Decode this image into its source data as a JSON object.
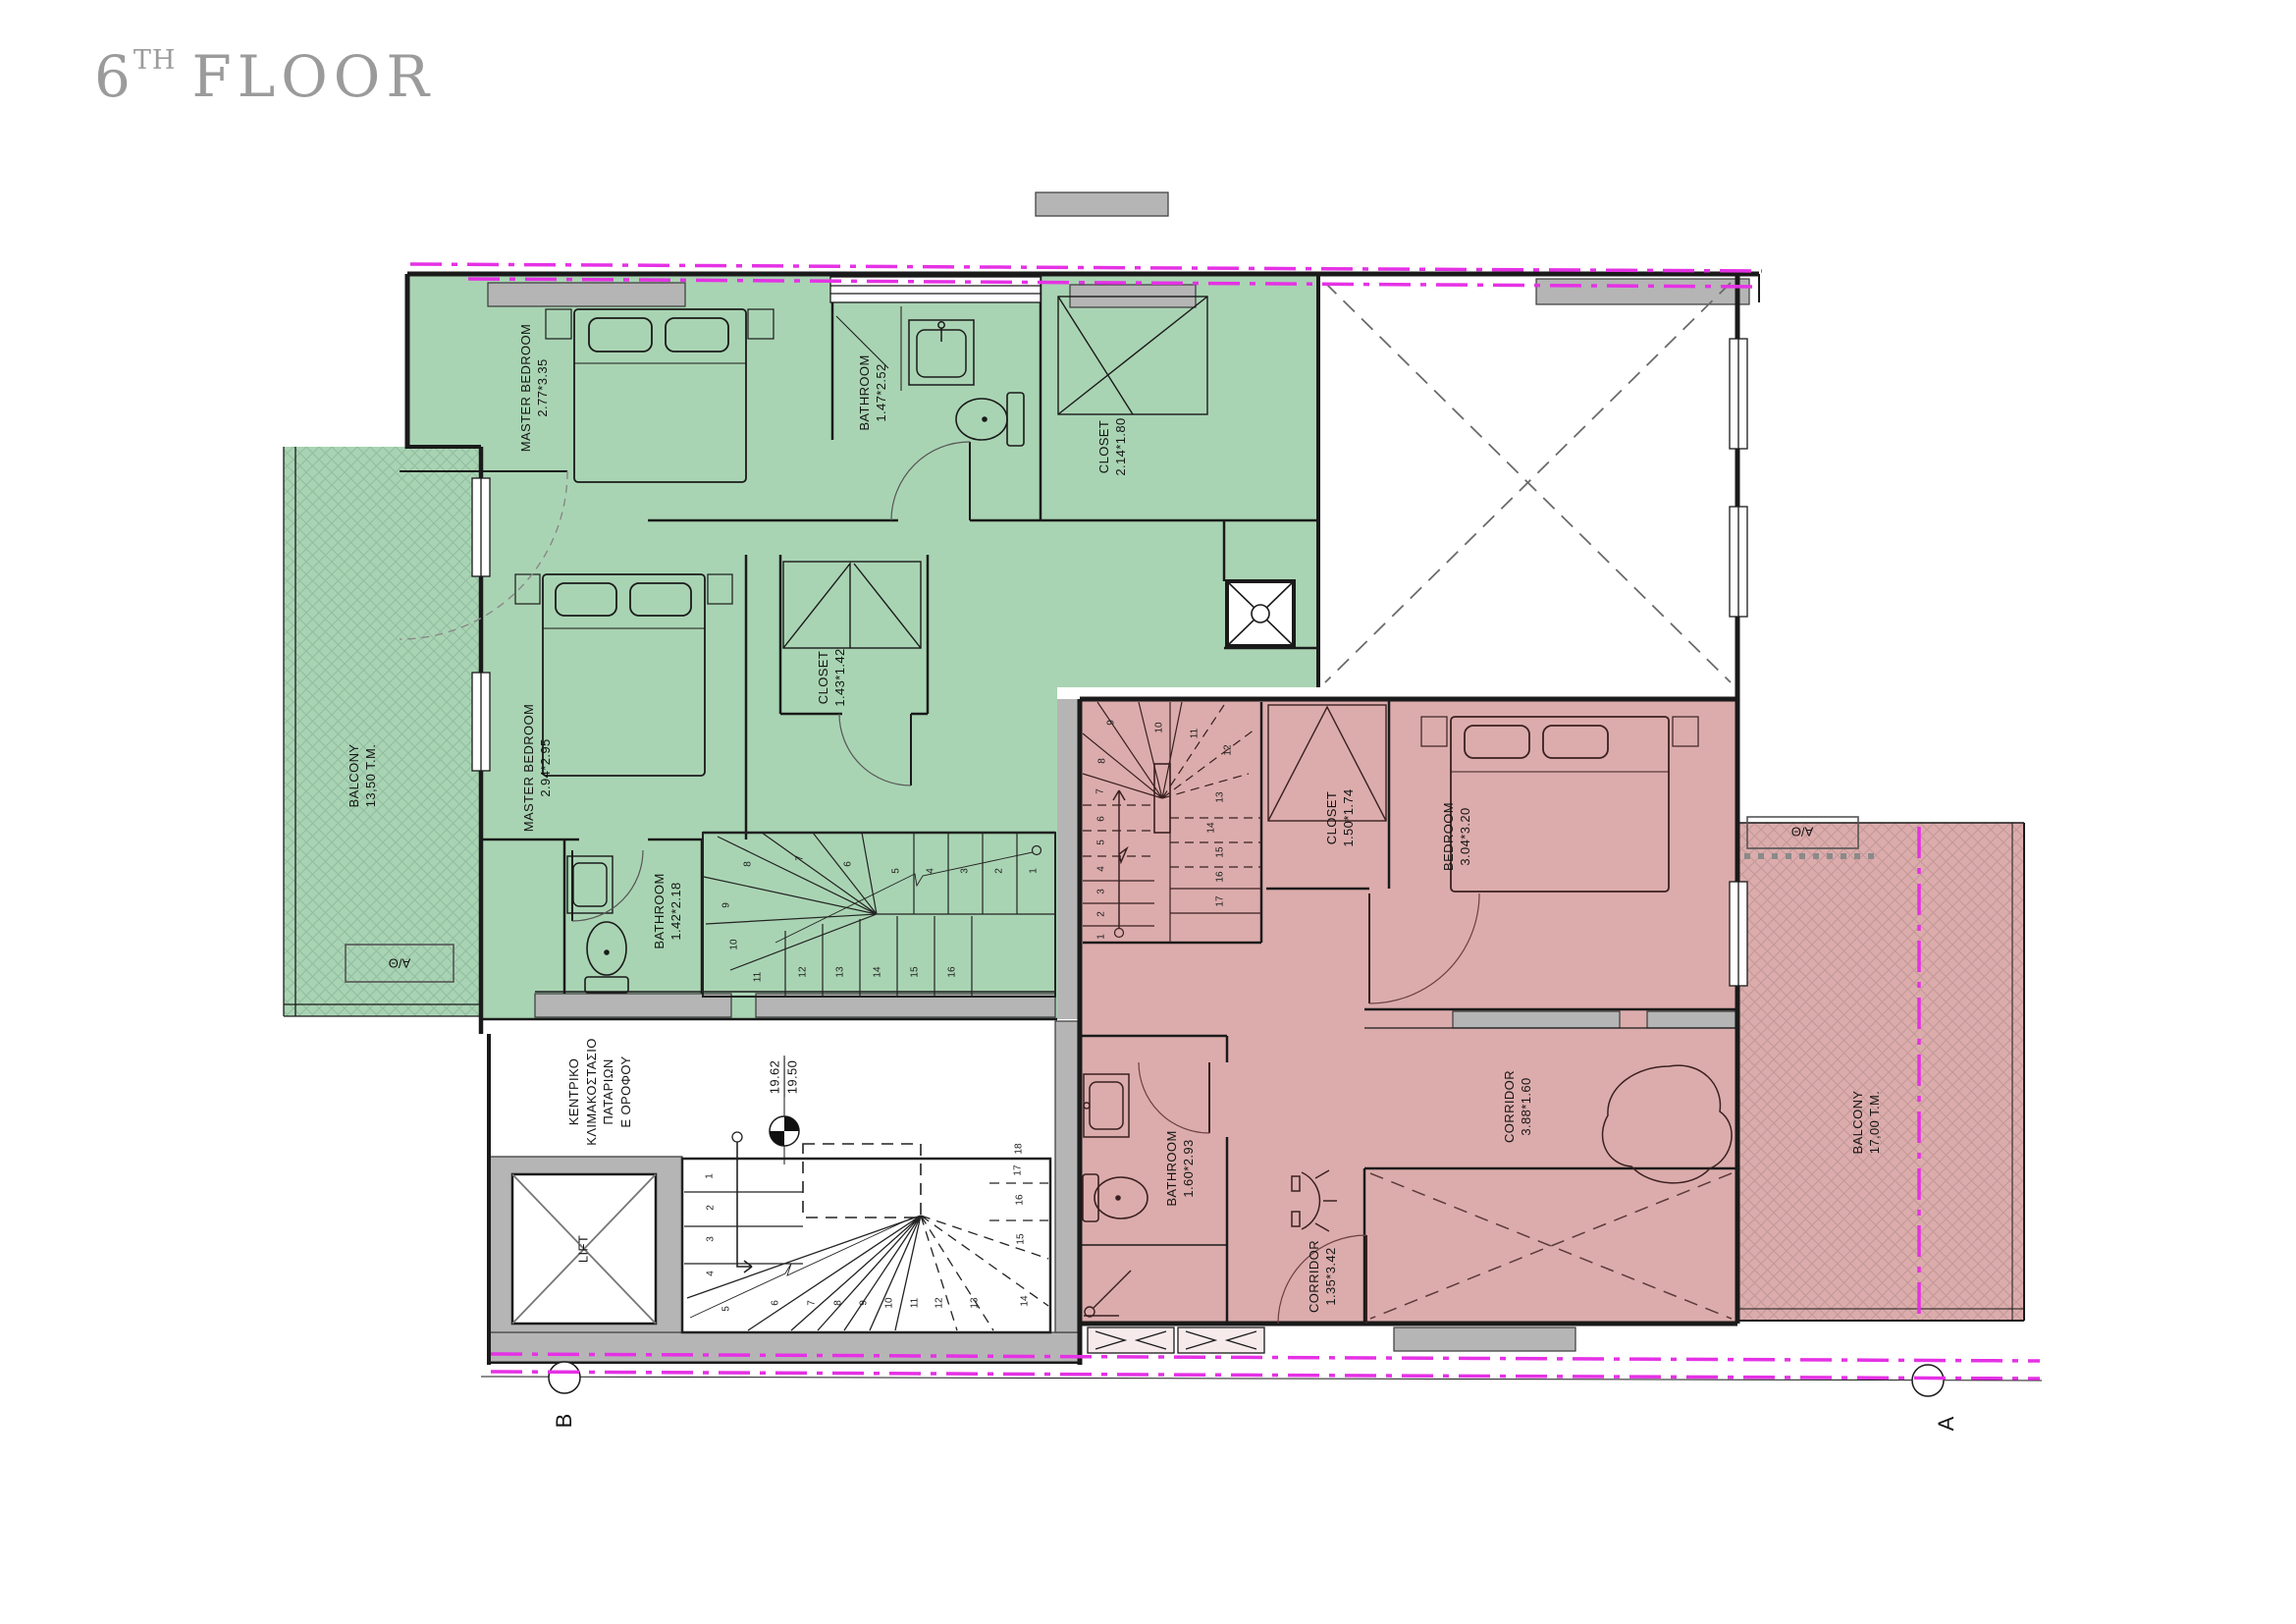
{
  "title": {
    "floor_number": "6",
    "ordinal_suffix": "TH",
    "floor_word": "FLOOR",
    "color": "#9b9b9b"
  },
  "green_unit": {
    "fill_color": "#a9d4b3",
    "rooms": {
      "master_bedroom_1": {
        "name": "MASTER BEDROOM",
        "dims": "2.77*3.35"
      },
      "bathroom_1": {
        "name": "BATHROOM",
        "dims": "1.47*2.52"
      },
      "closet_1": {
        "name": "CLOSET",
        "dims": "2.14*1.80"
      },
      "master_bedroom_2": {
        "name": "MASTER BEDROOM",
        "dims": "2.94*2.95"
      },
      "closet_2": {
        "name": "CLOSET",
        "dims": "1.43*1.42"
      },
      "bathroom_2": {
        "name": "BATHROOM",
        "dims": "1.42*2.18"
      },
      "balcony": {
        "name": "BALCONY",
        "area": "13,50 T.M."
      }
    },
    "ac_unit": "Α/Θ",
    "stair_treads": [
      "1",
      "2",
      "3",
      "4",
      "5",
      "6",
      "7",
      "8",
      "9",
      "10",
      "11",
      "12",
      "13",
      "14",
      "15",
      "16"
    ]
  },
  "pink_unit": {
    "fill_color": "#dcacac",
    "rooms": {
      "closet": {
        "name": "CLOSET",
        "dims": "1.50*1.74"
      },
      "bedroom": {
        "name": "BEDROOM",
        "dims": "3.04*3.20"
      },
      "bathroom": {
        "name": "BATHROOM",
        "dims": "1.60*2.93"
      },
      "corridor_entry": {
        "name": "CORRIDOR",
        "dims": "1.35*3.42"
      },
      "corridor_main": {
        "name": "CORRIDOR",
        "dims": "3.88*1.60"
      },
      "balcony": {
        "name": "BALCONY",
        "area": "17,00 T.M."
      }
    },
    "ac_unit": "Α/Θ",
    "stair_treads": [
      "1",
      "2",
      "3",
      "4",
      "5",
      "6",
      "7",
      "8",
      "9",
      "10",
      "11",
      "12",
      "13",
      "14",
      "15",
      "16",
      "17"
    ]
  },
  "core": {
    "stair_label_lines": [
      "ΚΕΝΤΡΙΚΟ",
      "ΚΛΙΜΑΚΟΣΤΑΣΙΟ",
      "ΠΑΤΑΡΙΩΝ",
      "Ε ΟΡΟΦΟΥ"
    ],
    "lift_label": "LIFT",
    "level_upper": "19.62",
    "level_lower": "19.50",
    "stair_treads": [
      "1",
      "2",
      "3",
      "4",
      "5",
      "6",
      "7",
      "8",
      "9",
      "10",
      "11",
      "12",
      "13",
      "14",
      "15",
      "16",
      "17",
      "18"
    ]
  },
  "section_markers": {
    "left": "B",
    "right": "A"
  },
  "colors": {
    "wall_gray": "#b5b5b5",
    "line_black": "#1a1a1a",
    "property_line_magenta": "#e531e5",
    "hatch_green": "#93bda1",
    "hatch_pink": "#c49898"
  }
}
